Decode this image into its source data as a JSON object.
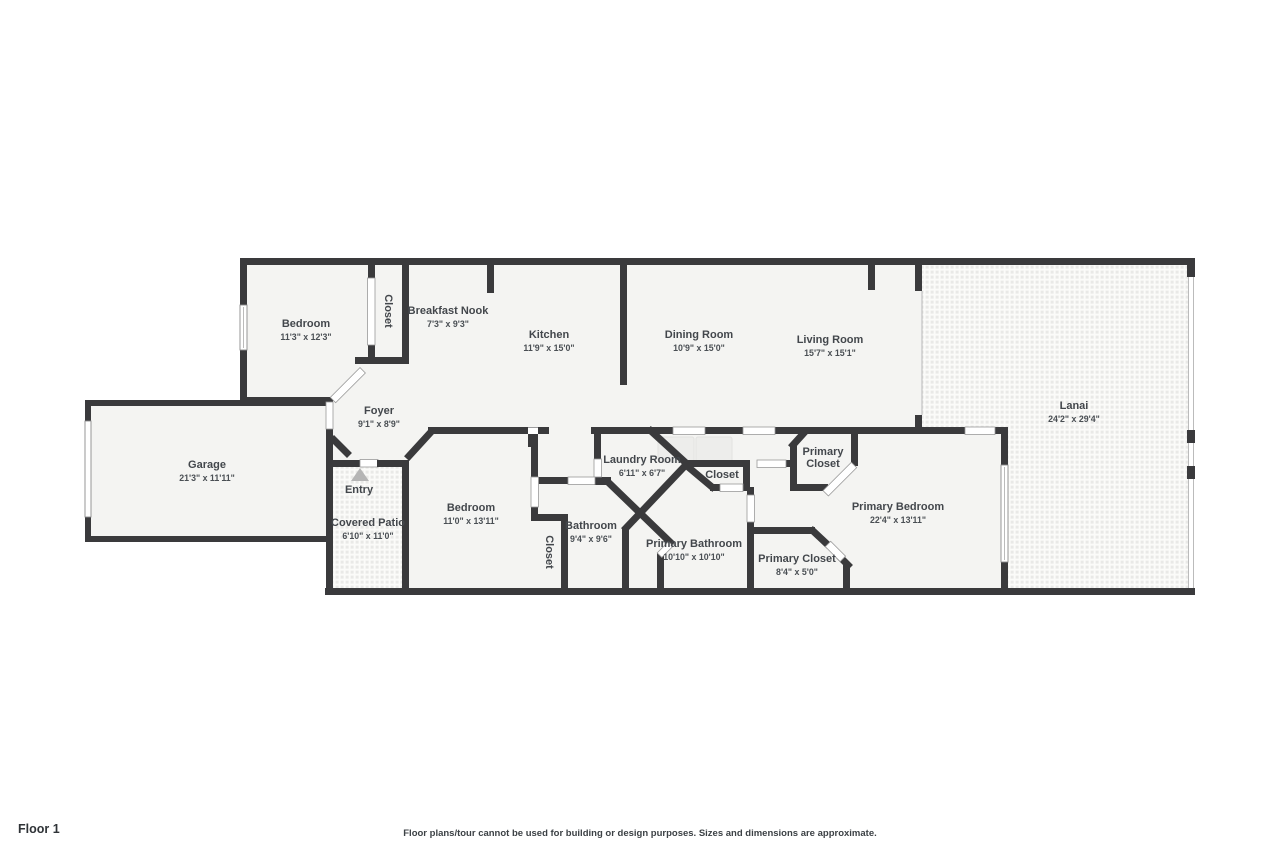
{
  "plan": {
    "floor_label": "Floor 1",
    "disclaimer": "Floor plans/tour cannot be used for building or design purposes. Sizes and dimensions are approximate.",
    "colors": {
      "wall": "#3a3a3c",
      "floor": "#f4f4f2",
      "background": "#ffffff",
      "label": "#43474c",
      "entry_arrow": "#b5b5b5",
      "texture_dot": "#e9e9e7"
    },
    "rooms": [
      {
        "name": "Bedroom",
        "dims": "11'3\" x 12'3\""
      },
      {
        "name": "Closet"
      },
      {
        "name": "Breakfast Nook",
        "dims": "7'3\" x 9'3\""
      },
      {
        "name": "Kitchen",
        "dims": "11'9\" x 15'0\""
      },
      {
        "name": "Dining Room",
        "dims": "10'9\" x 15'0\""
      },
      {
        "name": "Living Room",
        "dims": "15'7\" x 15'1\""
      },
      {
        "name": "Lanai",
        "dims": "24'2\" x 29'4\""
      },
      {
        "name": "Foyer",
        "dims": "9'1\" x 8'9\""
      },
      {
        "name": "Garage",
        "dims": "21'3\" x 11'11\""
      },
      {
        "name": "Entry"
      },
      {
        "name": "Covered Patio",
        "dims": "6'10\" x 11'0\""
      },
      {
        "name": "Bedroom",
        "dims": "11'0\" x 13'11\""
      },
      {
        "name": "Closet"
      },
      {
        "name": "Bathroom",
        "dims": "9'4\" x 9'6\""
      },
      {
        "name": "Laundry Room",
        "dims": "6'11\" x 6'7\""
      },
      {
        "name": "Closet"
      },
      {
        "name": "Primary Closet",
        "line1": "Primary",
        "line2": "Closet"
      },
      {
        "name": "Primary Bathroom",
        "dims": "10'10\" x 10'10\""
      },
      {
        "name": "Primary Closet",
        "dims": "8'4\" x 5'0\""
      },
      {
        "name": "Primary Bedroom",
        "dims": "22'4\" x 13'11\""
      }
    ]
  }
}
